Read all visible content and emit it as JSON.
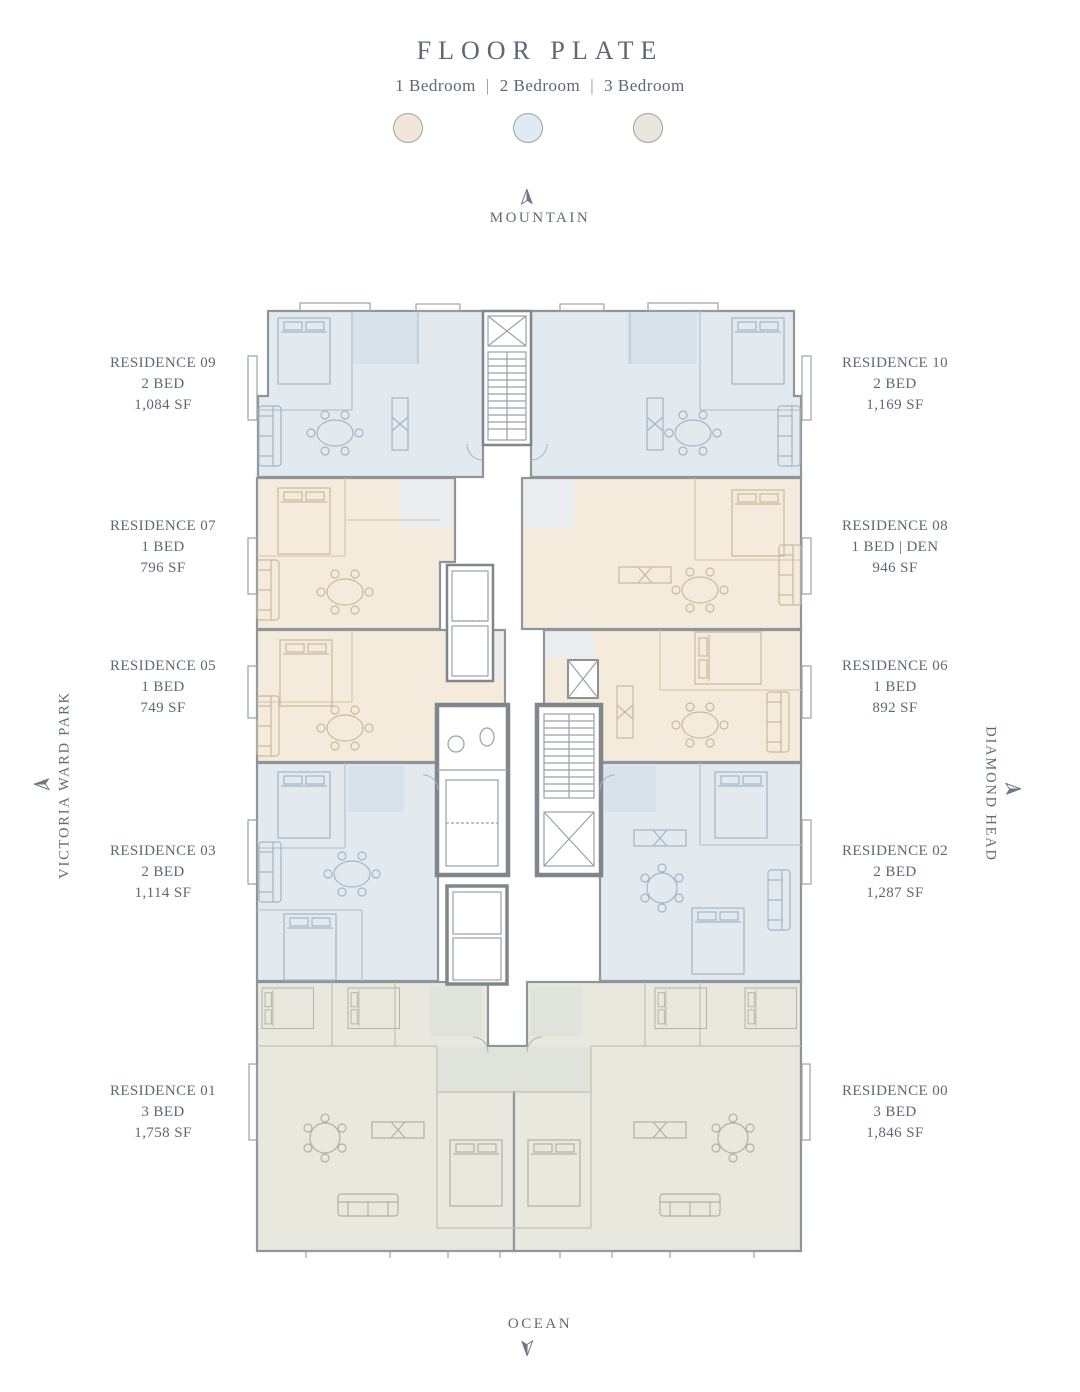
{
  "page": {
    "title": "FLOOR PLATE"
  },
  "legend": {
    "separator": "|",
    "items": [
      {
        "label": "1 Bedroom",
        "color": "#f2e6d8"
      },
      {
        "label": "2 Bedroom",
        "color": "#e0ebf1"
      },
      {
        "label": "3 Bedroom",
        "color": "#e7e7dc"
      }
    ]
  },
  "compass": {
    "north": "MOUNTAIN",
    "south": "OCEAN",
    "west": "VICTORIA WARD PARK",
    "east": "DIAMOND HEAD"
  },
  "residences": {
    "left": [
      {
        "name": "RESIDENCE 09",
        "beds": "2 BED",
        "area": "1,084 SF"
      },
      {
        "name": "RESIDENCE 07",
        "beds": "1 BED",
        "area": "796 SF"
      },
      {
        "name": "RESIDENCE 05",
        "beds": "1 BED",
        "area": "749 SF"
      },
      {
        "name": "RESIDENCE 03",
        "beds": "2 BED",
        "area": "1,114 SF"
      },
      {
        "name": "RESIDENCE 01",
        "beds": "3 BED",
        "area": "1,758 SF"
      }
    ],
    "right": [
      {
        "name": "RESIDENCE 10",
        "beds": "2 BED",
        "area": "1,169 SF"
      },
      {
        "name": "RESIDENCE 08",
        "beds": "1 BED | DEN",
        "area": "946 SF"
      },
      {
        "name": "RESIDENCE 06",
        "beds": "1 BED",
        "area": "892 SF"
      },
      {
        "name": "RESIDENCE 02",
        "beds": "2 BED",
        "area": "1,287 SF"
      },
      {
        "name": "RESIDENCE 00",
        "beds": "3 BED",
        "area": "1,846 SF"
      }
    ]
  },
  "colors": {
    "text": "#5c6975",
    "one_bedroom_fill": "#f5ebdd",
    "two_bedroom_fill": "#e2eaf0",
    "three_bedroom_fill": "#e8e8de",
    "walls": "#8e969c",
    "core_walls": "#7f868c"
  }
}
